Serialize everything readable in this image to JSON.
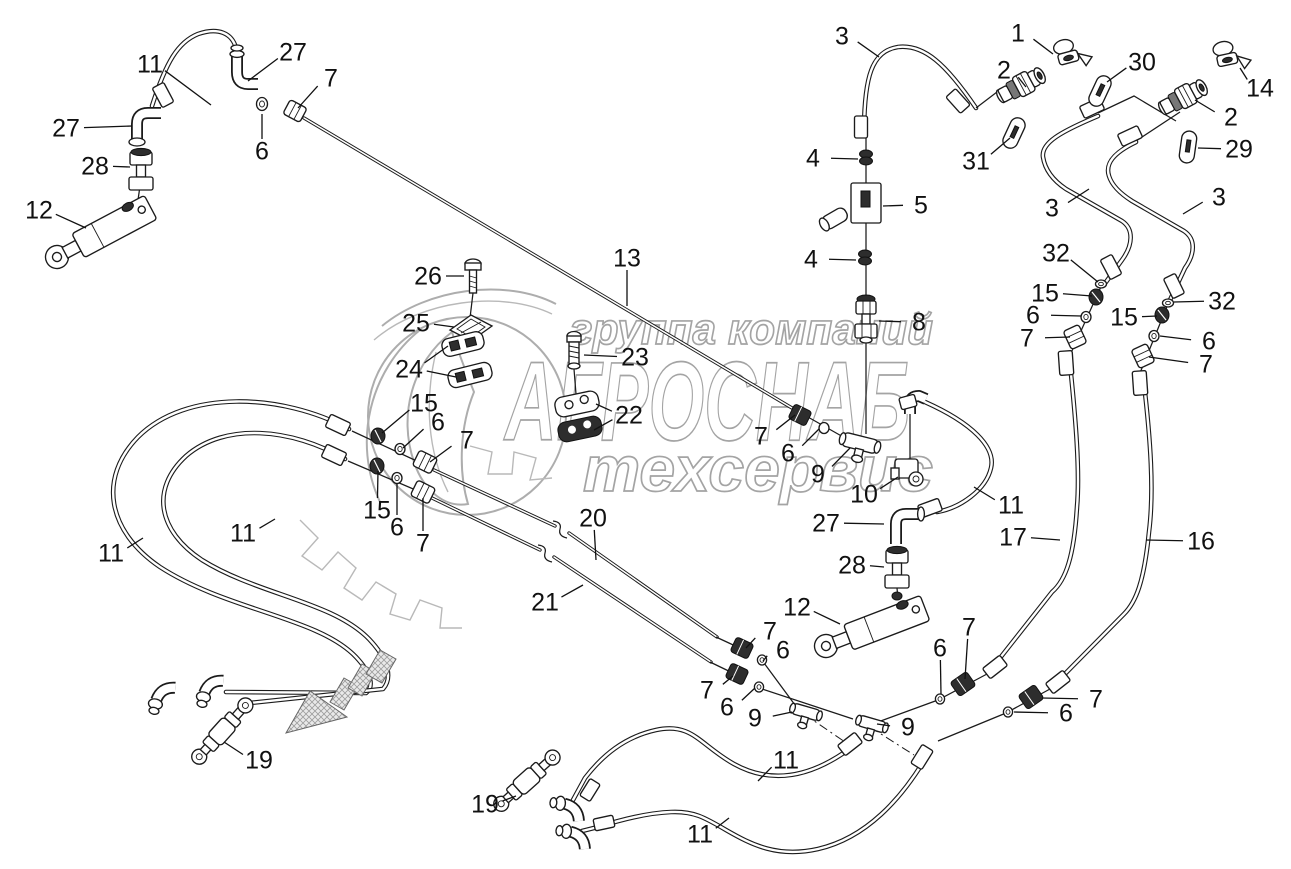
{
  "watermark": {
    "line1": "группа компаний",
    "line2": "АГРОСНАБ",
    "line3": "техсервис"
  },
  "colors": {
    "diagram_line": "#1b1b1b",
    "watermark_gray": "#a4a4a4",
    "background": "#ffffff"
  },
  "diagram": {
    "callouts": [
      {
        "label": "11",
        "x": 150,
        "y": 64,
        "leads": [
          [
            211,
            105
          ]
        ]
      },
      {
        "label": "27",
        "x": 293,
        "y": 52,
        "leads": [
          [
            248,
            81
          ]
        ]
      },
      {
        "label": "7",
        "x": 331,
        "y": 78,
        "leads": [
          [
            298,
            108
          ]
        ]
      },
      {
        "label": "27",
        "x": 66,
        "y": 128,
        "leads": [
          [
            132,
            126
          ]
        ]
      },
      {
        "label": "28",
        "x": 95,
        "y": 166,
        "leads": [
          [
            130,
            167
          ]
        ]
      },
      {
        "label": "6",
        "x": 262,
        "y": 151,
        "leads": [
          [
            262,
            114
          ]
        ]
      },
      {
        "label": "12",
        "x": 39,
        "y": 210,
        "leads": [
          [
            86,
            228
          ]
        ]
      },
      {
        "label": "3",
        "x": 842,
        "y": 36,
        "leads": [
          [
            879,
            57
          ]
        ]
      },
      {
        "label": "1",
        "x": 1018,
        "y": 33,
        "leads": [
          [
            1053,
            54
          ]
        ]
      },
      {
        "label": "2",
        "x": 1004,
        "y": 70,
        "leads": [
          [
            1026,
            87
          ]
        ]
      },
      {
        "label": "30",
        "x": 1142,
        "y": 62,
        "leads": [
          [
            1107,
            82
          ]
        ]
      },
      {
        "label": "14",
        "x": 1260,
        "y": 88,
        "leads": [
          [
            1240,
            68
          ]
        ]
      },
      {
        "label": "2",
        "x": 1231,
        "y": 117,
        "leads": [
          [
            1195,
            100
          ]
        ]
      },
      {
        "label": "31",
        "x": 976,
        "y": 161,
        "leads": [
          [
            1010,
            138
          ]
        ]
      },
      {
        "label": "29",
        "x": 1239,
        "y": 149,
        "leads": [
          [
            1198,
            148
          ]
        ]
      },
      {
        "label": "4",
        "x": 813,
        "y": 158,
        "leads": [
          [
            858,
            159
          ]
        ]
      },
      {
        "label": "5",
        "x": 921,
        "y": 205,
        "leads": [
          [
            883,
            206
          ]
        ]
      },
      {
        "label": "4",
        "x": 811,
        "y": 259,
        "leads": [
          [
            856,
            260
          ]
        ]
      },
      {
        "label": "8",
        "x": 919,
        "y": 322,
        "leads": [
          [
            879,
            321
          ]
        ]
      },
      {
        "label": "3",
        "x": 1052,
        "y": 208,
        "leads": [
          [
            1089,
            189
          ]
        ]
      },
      {
        "label": "3",
        "x": 1219,
        "y": 197,
        "leads": [
          [
            1183,
            214
          ]
        ]
      },
      {
        "label": "32",
        "x": 1056,
        "y": 253,
        "leads": [
          [
            1098,
            282
          ]
        ]
      },
      {
        "label": "15",
        "x": 1045,
        "y": 293,
        "leads": [
          [
            1092,
            296
          ]
        ]
      },
      {
        "label": "6",
        "x": 1033,
        "y": 315,
        "leads": [
          [
            1081,
            316
          ]
        ]
      },
      {
        "label": "7",
        "x": 1027,
        "y": 338,
        "leads": [
          [
            1070,
            337
          ]
        ]
      },
      {
        "label": "32",
        "x": 1222,
        "y": 301,
        "leads": [
          [
            1174,
            302
          ]
        ]
      },
      {
        "label": "15",
        "x": 1124,
        "y": 317,
        "leads": [
          [
            1157,
            316
          ]
        ]
      },
      {
        "label": "6",
        "x": 1209,
        "y": 341,
        "leads": [
          [
            1160,
            336
          ]
        ]
      },
      {
        "label": "7",
        "x": 1206,
        "y": 364,
        "leads": [
          [
            1149,
            357
          ]
        ]
      },
      {
        "label": "26",
        "x": 428,
        "y": 276,
        "leads": [
          [
            464,
            276
          ]
        ]
      },
      {
        "label": "25",
        "x": 416,
        "y": 323,
        "leads": [
          [
            454,
            327
          ]
        ]
      },
      {
        "label": "24",
        "x": 409,
        "y": 369,
        "leads": [
          [
            448,
            346
          ],
          [
            456,
            377
          ]
        ]
      },
      {
        "label": "13",
        "x": 627,
        "y": 258,
        "leads": [
          [
            627,
            306
          ]
        ]
      },
      {
        "label": "23",
        "x": 635,
        "y": 357,
        "leads": [
          [
            584,
            355
          ]
        ]
      },
      {
        "label": "22",
        "x": 629,
        "y": 415,
        "leads": [
          [
            596,
            404
          ],
          [
            594,
            430
          ]
        ]
      },
      {
        "label": "15",
        "x": 424,
        "y": 403,
        "leads": [
          [
            382,
            433
          ]
        ]
      },
      {
        "label": "6",
        "x": 438,
        "y": 422,
        "leads": [
          [
            403,
            448
          ]
        ]
      },
      {
        "label": "7",
        "x": 467,
        "y": 440,
        "leads": [
          [
            430,
            462
          ]
        ]
      },
      {
        "label": "15",
        "x": 377,
        "y": 510,
        "leads": [
          [
            378,
            471
          ]
        ]
      },
      {
        "label": "6",
        "x": 397,
        "y": 527,
        "leads": [
          [
            397,
            483
          ]
        ]
      },
      {
        "label": "7",
        "x": 423,
        "y": 543,
        "leads": [
          [
            423,
            498
          ]
        ]
      },
      {
        "label": "7",
        "x": 761,
        "y": 436,
        "leads": [
          [
            795,
            415
          ]
        ]
      },
      {
        "label": "6",
        "x": 788,
        "y": 453,
        "leads": [
          [
            819,
            429
          ]
        ]
      },
      {
        "label": "9",
        "x": 818,
        "y": 474,
        "leads": [
          [
            850,
            448
          ]
        ]
      },
      {
        "label": "10",
        "x": 864,
        "y": 494,
        "leads": [
          [
            898,
            477
          ]
        ]
      },
      {
        "label": "11",
        "x": 1011,
        "y": 505,
        "leads": [
          [
            974,
            487
          ]
        ]
      },
      {
        "label": "27",
        "x": 826,
        "y": 523,
        "leads": [
          [
            884,
            524
          ]
        ]
      },
      {
        "label": "28",
        "x": 852,
        "y": 565,
        "leads": [
          [
            884,
            567
          ]
        ]
      },
      {
        "label": "12",
        "x": 797,
        "y": 607,
        "leads": [
          [
            840,
            624
          ]
        ]
      },
      {
        "label": "17",
        "x": 1013,
        "y": 537,
        "leads": [
          [
            1060,
            540
          ]
        ]
      },
      {
        "label": "16",
        "x": 1201,
        "y": 541,
        "leads": [
          [
            1146,
            540
          ]
        ]
      },
      {
        "label": "20",
        "x": 593,
        "y": 518,
        "leads": [
          [
            596,
            560
          ]
        ]
      },
      {
        "label": "21",
        "x": 545,
        "y": 602,
        "leads": [
          [
            583,
            585
          ]
        ]
      },
      {
        "label": "11",
        "x": 111,
        "y": 553,
        "leads": [
          [
            143,
            538
          ]
        ]
      },
      {
        "label": "11",
        "x": 243,
        "y": 533,
        "leads": [
          [
            275,
            519
          ]
        ]
      },
      {
        "label": "19",
        "x": 259,
        "y": 760,
        "leads": [
          [
            224,
            742
          ]
        ]
      },
      {
        "label": "7",
        "x": 770,
        "y": 631,
        "leads": [
          [
            746,
            648
          ]
        ]
      },
      {
        "label": "6",
        "x": 783,
        "y": 650,
        "leads": [
          [
            763,
            661
          ]
        ]
      },
      {
        "label": "7",
        "x": 707,
        "y": 690,
        "leads": [
          [
            733,
            676
          ]
        ]
      },
      {
        "label": "6",
        "x": 727,
        "y": 707,
        "leads": [
          [
            755,
            688
          ]
        ]
      },
      {
        "label": "9",
        "x": 755,
        "y": 718,
        "leads": [
          [
            792,
            712
          ]
        ]
      },
      {
        "label": "9",
        "x": 908,
        "y": 727,
        "leads": [
          [
            877,
            724
          ]
        ]
      },
      {
        "label": "6",
        "x": 940,
        "y": 648,
        "leads": [
          [
            941,
            694
          ]
        ]
      },
      {
        "label": "7",
        "x": 969,
        "y": 627,
        "leads": [
          [
            965,
            679
          ]
        ]
      },
      {
        "label": "7",
        "x": 1096,
        "y": 699,
        "leads": [
          [
            1042,
            698
          ]
        ]
      },
      {
        "label": "6",
        "x": 1066,
        "y": 713,
        "leads": [
          [
            1014,
            712
          ]
        ]
      },
      {
        "label": "19",
        "x": 485,
        "y": 804,
        "leads": [
          [
            516,
            796
          ]
        ]
      },
      {
        "label": "11",
        "x": 786,
        "y": 760,
        "leads": [
          [
            758,
            781
          ]
        ]
      },
      {
        "label": "11",
        "x": 700,
        "y": 834,
        "leads": [
          [
            729,
            818
          ]
        ]
      }
    ]
  }
}
